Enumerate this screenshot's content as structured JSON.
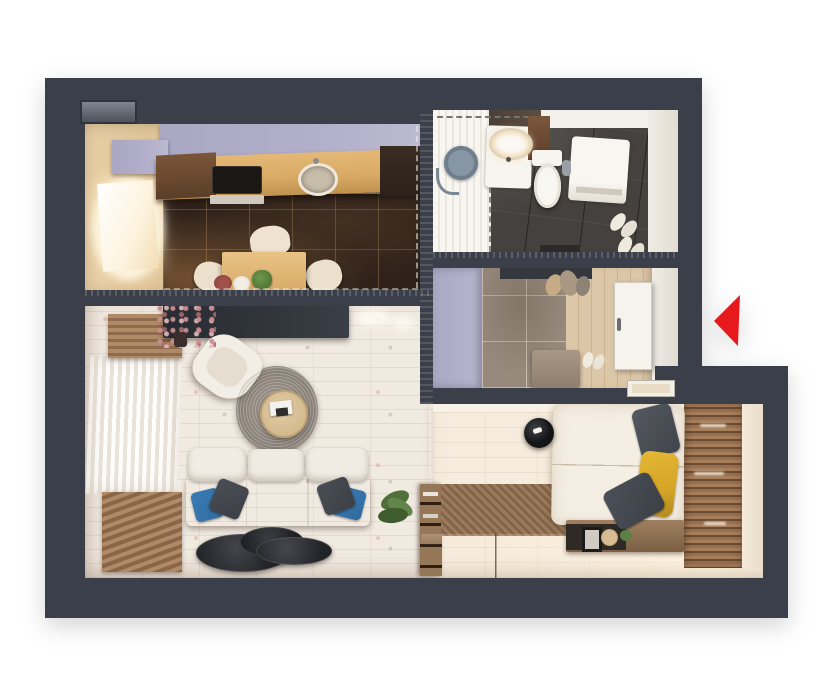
{
  "title": "3D top-view floor plan of a one-bedroom apartment",
  "view": "top-down 3d architectural render, no text labels",
  "palette": {
    "background": "#ffffff",
    "wall": "#3b3f49",
    "entrance-arrow": "#e8191c",
    "lavender-cabinet": "#b1afc9",
    "kitchen-floor": "#30221a",
    "kitchen-counter": "#d9ab66",
    "bathroom-floor": "#45413e",
    "hall-tile": "#97897b",
    "hall-wood": "#d9c3a4",
    "living-floor": "#f1eae1",
    "bedroom-floor": "#f6ecdd",
    "wood-slat": "#a87c58",
    "platform-wood": "#8d6f52",
    "bedding": "#f4eee3",
    "sofa": "#ede9e1",
    "pillow-blue": "#2f6ba0",
    "pillow-dark": "#3c4046",
    "pillow-yellow": "#d5a527",
    "rug": "#9b938a",
    "tv-console": "#31353c",
    "door-white": "#f6f3ed",
    "fixture-white": "#f7f5f0"
  },
  "rooms": {
    "kitchen": {
      "name": "Kitchen",
      "furniture": [
        "wall cabinets",
        "counter with cooktop and sink",
        "oven",
        "dining table",
        "three chairs",
        "window",
        "dark marble tile floor"
      ]
    },
    "bathroom": {
      "name": "Bathroom",
      "furniture": [
        "shower zone",
        "vanity with basin",
        "toilet",
        "washing machine",
        "towel rail",
        "slippers",
        "dark tile floor"
      ]
    },
    "hallway": {
      "name": "Entrance hall",
      "furniture": [
        "wardrobe",
        "coat hooks",
        "bench",
        "entrance door",
        "slippers",
        "tile and wood floor"
      ]
    },
    "living-room": {
      "name": "Living room",
      "furniture": [
        "tv console",
        "flower vase",
        "armchair",
        "round rug",
        "round coffee table",
        "three-seat sofa",
        "blue and grey cushions",
        "nesting side tables",
        "plant",
        "curtained windows",
        "wood slat panels"
      ]
    },
    "sleeping-area": {
      "name": "Sleeping area",
      "furniture": [
        "platform bed with bookshelf",
        "mattress with pillows",
        "pendant lamp",
        "low sideboard with decor",
        "wood slat accent wall"
      ]
    }
  },
  "markers": {
    "entrance-arrow": {
      "label": "Entrance",
      "direction": "left",
      "color": "#e8191c"
    }
  }
}
